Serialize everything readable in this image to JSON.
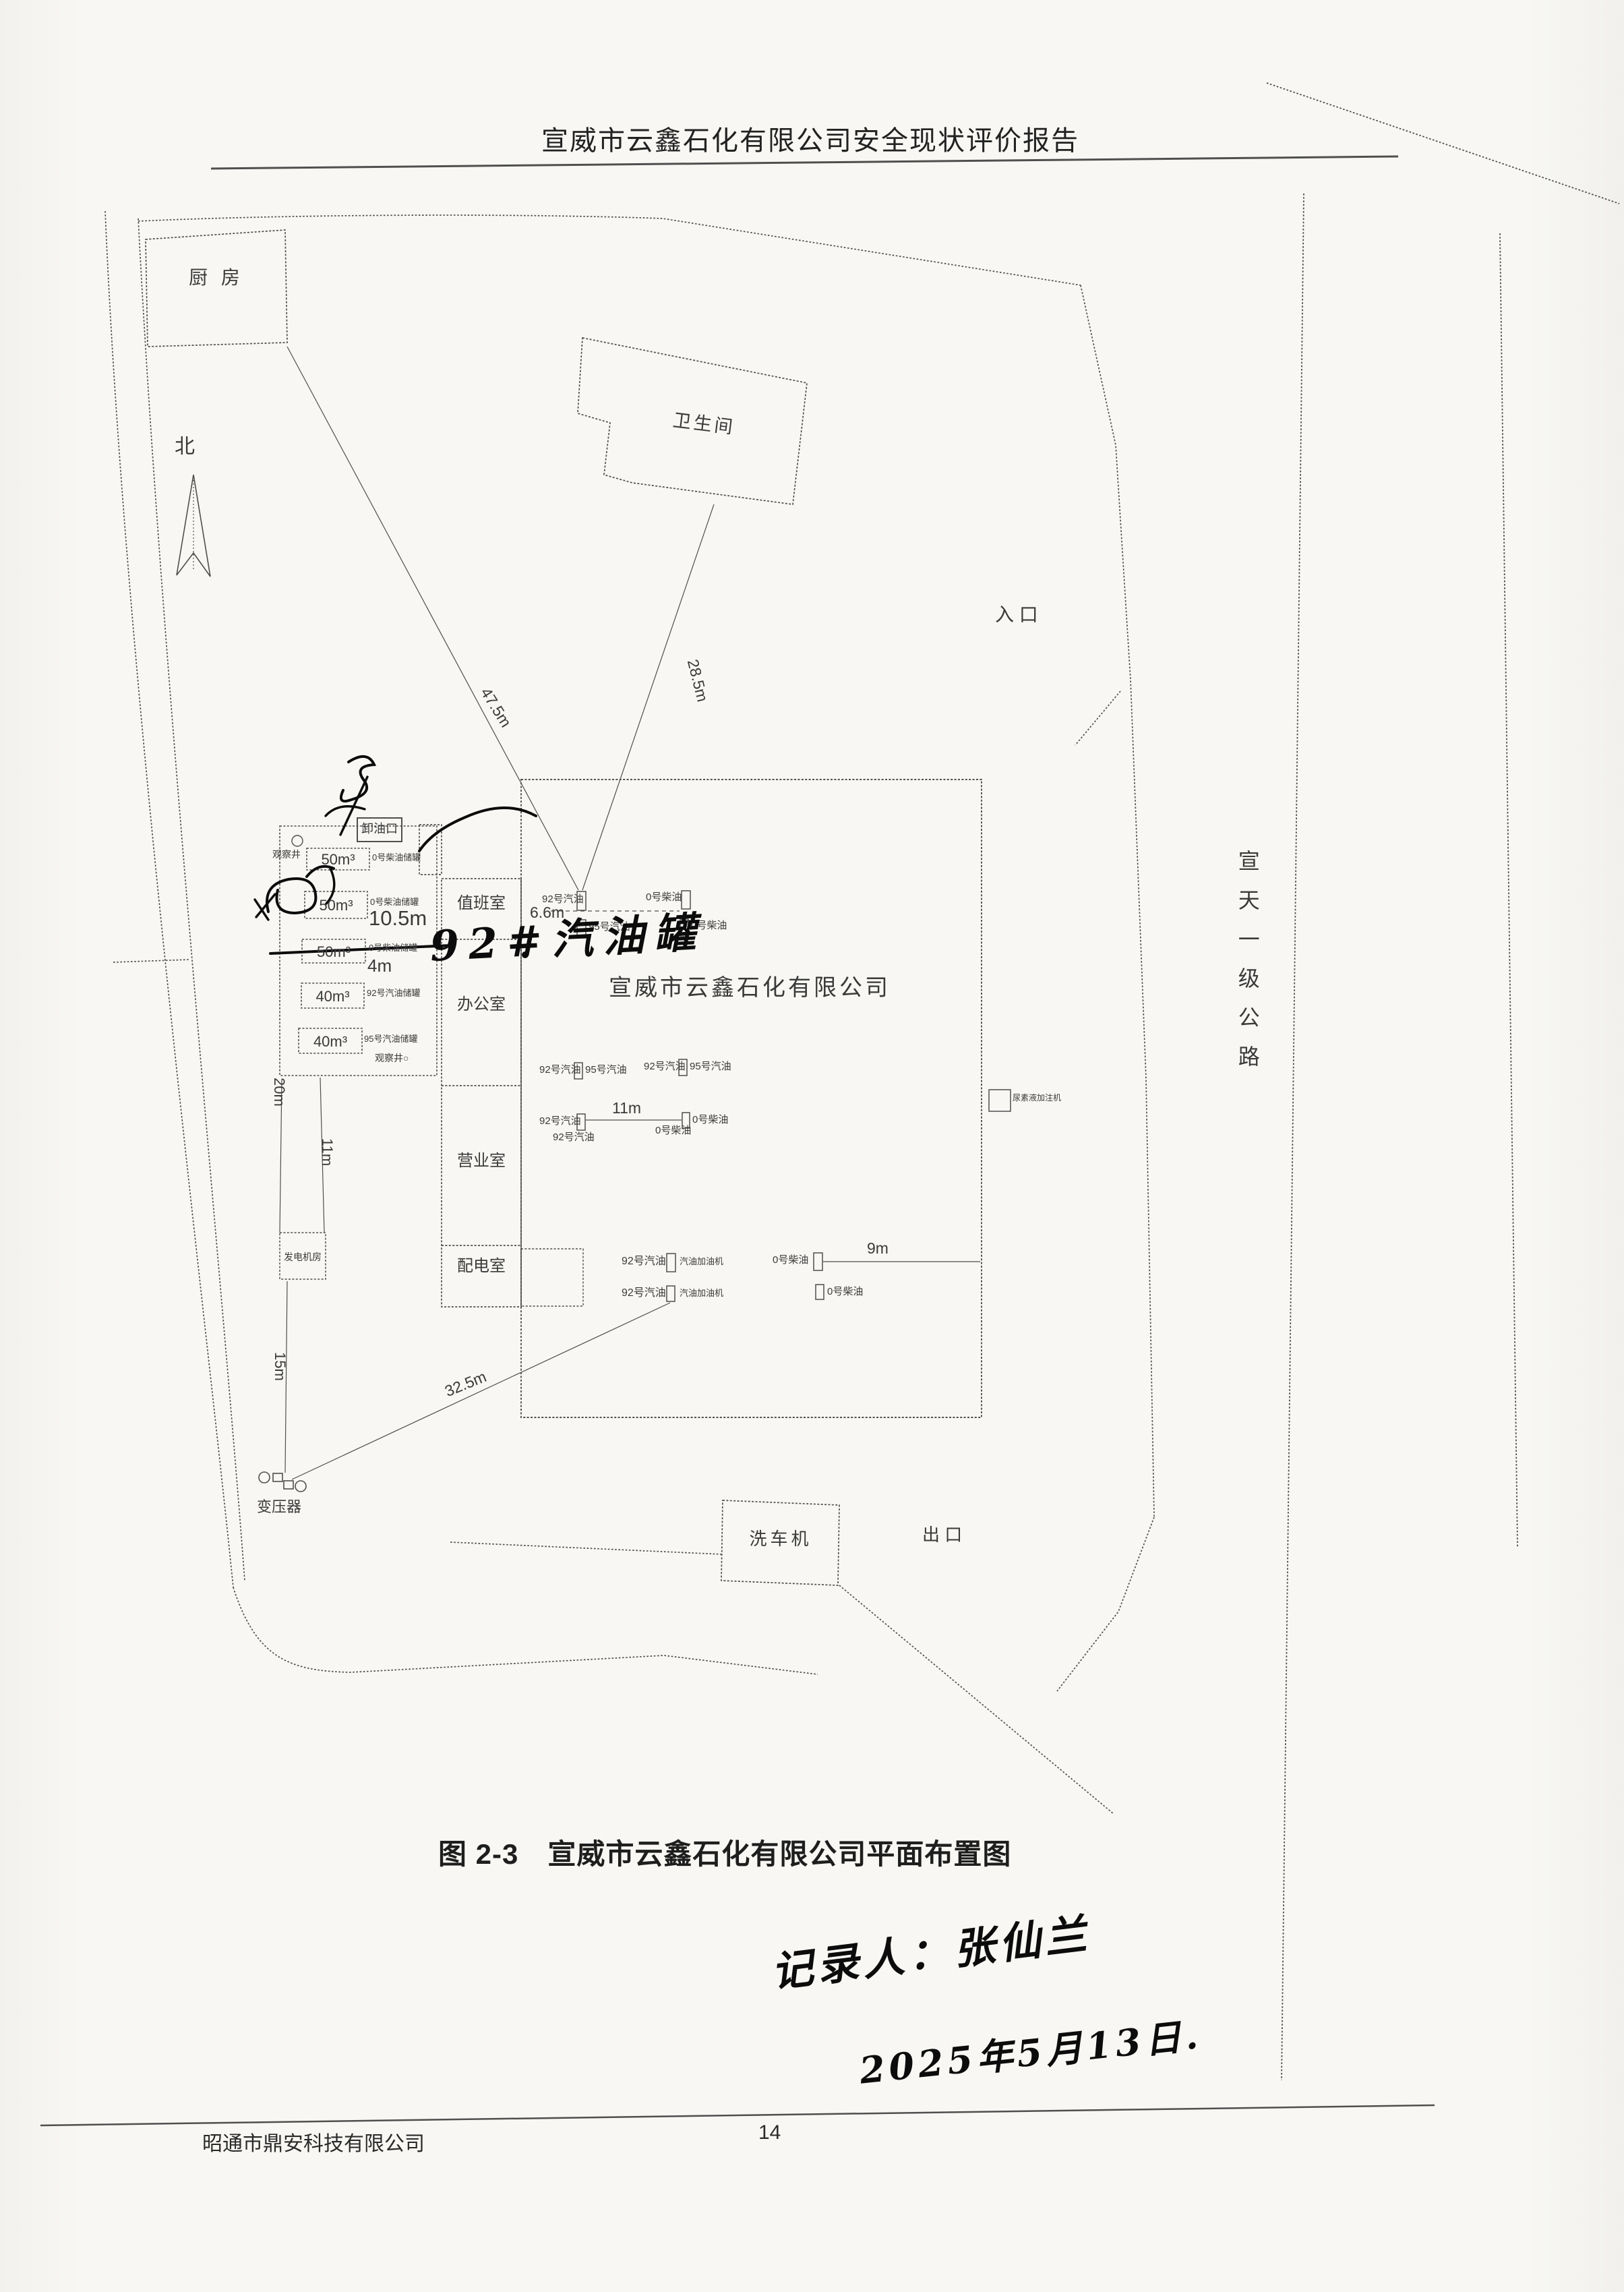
{
  "page": {
    "header_title": "宣威市云鑫石化有限公司安全现状评价报告",
    "caption": "图 2-3　宣威市云鑫石化有限公司平面布置图",
    "footer_company": "昭通市鼎安科技有限公司",
    "page_number": "14"
  },
  "plan": {
    "north_label": "北",
    "entrance_label": "入  口",
    "exit_label": "出  口",
    "road_name": "宣天一级公路",
    "buildings": {
      "kitchen": "厨  房",
      "toilet": "卫生间",
      "duty_room": "值班室",
      "office": "办公室",
      "business_room": "营业室",
      "power_room": "配电室",
      "generator_room": "发电机房",
      "car_washer": "洗车机",
      "company_canopy": "宣威市云鑫石化有限公司"
    },
    "tank_area": {
      "unloading_port": "卸油口",
      "observation_well": "观察井",
      "observation_well_2": "观察井○",
      "tanks": [
        {
          "volume": "50m³",
          "product": "0号柴油储罐"
        },
        {
          "volume": "50m³",
          "product": "0号柴油储罐"
        },
        {
          "volume": "50m³",
          "product": "0号柴油储罐"
        },
        {
          "volume": "40m³",
          "product": "92号汽油储罐"
        },
        {
          "volume": "40m³",
          "product": "95号汽油储罐"
        }
      ]
    },
    "dispenser_labels": {
      "g92": "92号汽油",
      "g95": "95号汽油",
      "d0": "0号柴油",
      "pump": "汽油加油机",
      "urea": "尿素液加注机"
    },
    "equipment": {
      "transformer": "变压器"
    },
    "dimensions": {
      "kitchen_to_island": "47.5m",
      "toilet_to_island": "28.5m",
      "tank_gap_large": "10.5m",
      "tank_gap_small": "4m",
      "island_gap": "6.6m",
      "island_spacing": "11m",
      "diesel_to_edge": "9m",
      "corridor_left": "20m",
      "corridor_right": "11m",
      "generator_to_transformer": "15m",
      "transformer_to_island": "32.5m"
    }
  },
  "handwriting": {
    "tank_note": "92#汽油罐",
    "recorder": "记录人：张仙兰",
    "date": "2025年5月13日."
  }
}
